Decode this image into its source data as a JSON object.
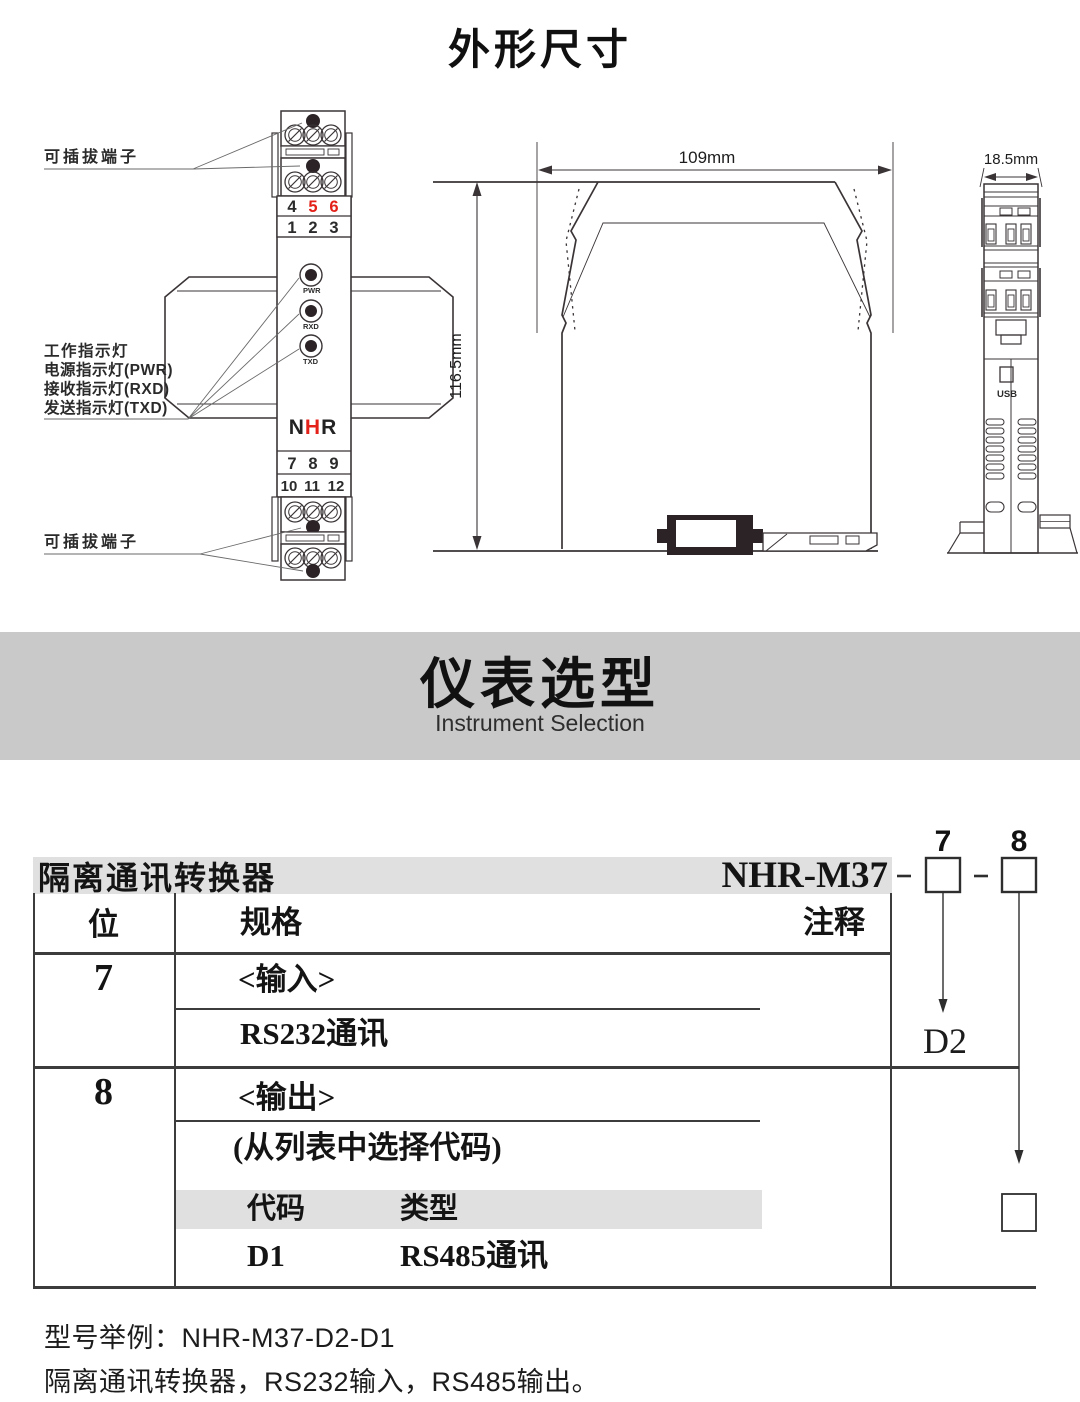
{
  "page": {
    "title": "外形尺寸"
  },
  "front_view": {
    "plug_label_top": "可插拔端子",
    "plug_label_bottom": "可插拔端子",
    "indicator_labels": [
      "工作指示灯",
      "电源指示灯(PWR)",
      "接收指示灯(RXD)",
      "发送指示灯(TXD)"
    ],
    "led_labels": [
      "PWR",
      "RXD",
      "TXD"
    ],
    "logo": [
      "N",
      "H",
      "R"
    ],
    "terminal_numbers_top": [
      "4",
      "5",
      "6"
    ],
    "terminal_numbers_top2": [
      "1",
      "2",
      "3"
    ],
    "terminal_numbers_bottom": [
      "7",
      "8",
      "9"
    ],
    "terminal_numbers_bottom2": [
      "10",
      "11",
      "12"
    ]
  },
  "side_view": {
    "width_dim": "109mm",
    "height_dim": "116.5mm"
  },
  "profile_view": {
    "width_dim": "18.5mm",
    "usb_label": "USB"
  },
  "banner": {
    "title": "仪表选型",
    "subtitle": "Instrument Selection"
  },
  "selection": {
    "product_name": "隔离通讯转换器",
    "model": "NHR-M37",
    "position_labels": [
      "7",
      "8"
    ],
    "note_d2": "D2",
    "table": {
      "header": {
        "position": "位",
        "spec": "规格",
        "note": "注释"
      },
      "row7": {
        "position": "7",
        "title": "<输入>",
        "value": "RS232通讯"
      },
      "row8": {
        "position": "8",
        "title": "<输出>",
        "hint": "(从列表中选择代码)",
        "code_header": "代码",
        "type_header": "类型",
        "code": "D1",
        "type": "RS485通讯"
      }
    },
    "example": {
      "model_line": "型号举例：NHR-M37-D2-D1",
      "description": "隔离通讯转换器，RS232输入，RS485输出。"
    }
  },
  "colors": {
    "accent_red": "#e32119",
    "banner_bg": "#c9c9c9",
    "bar_bg": "#e0e0e0",
    "line": "#3a3436"
  }
}
